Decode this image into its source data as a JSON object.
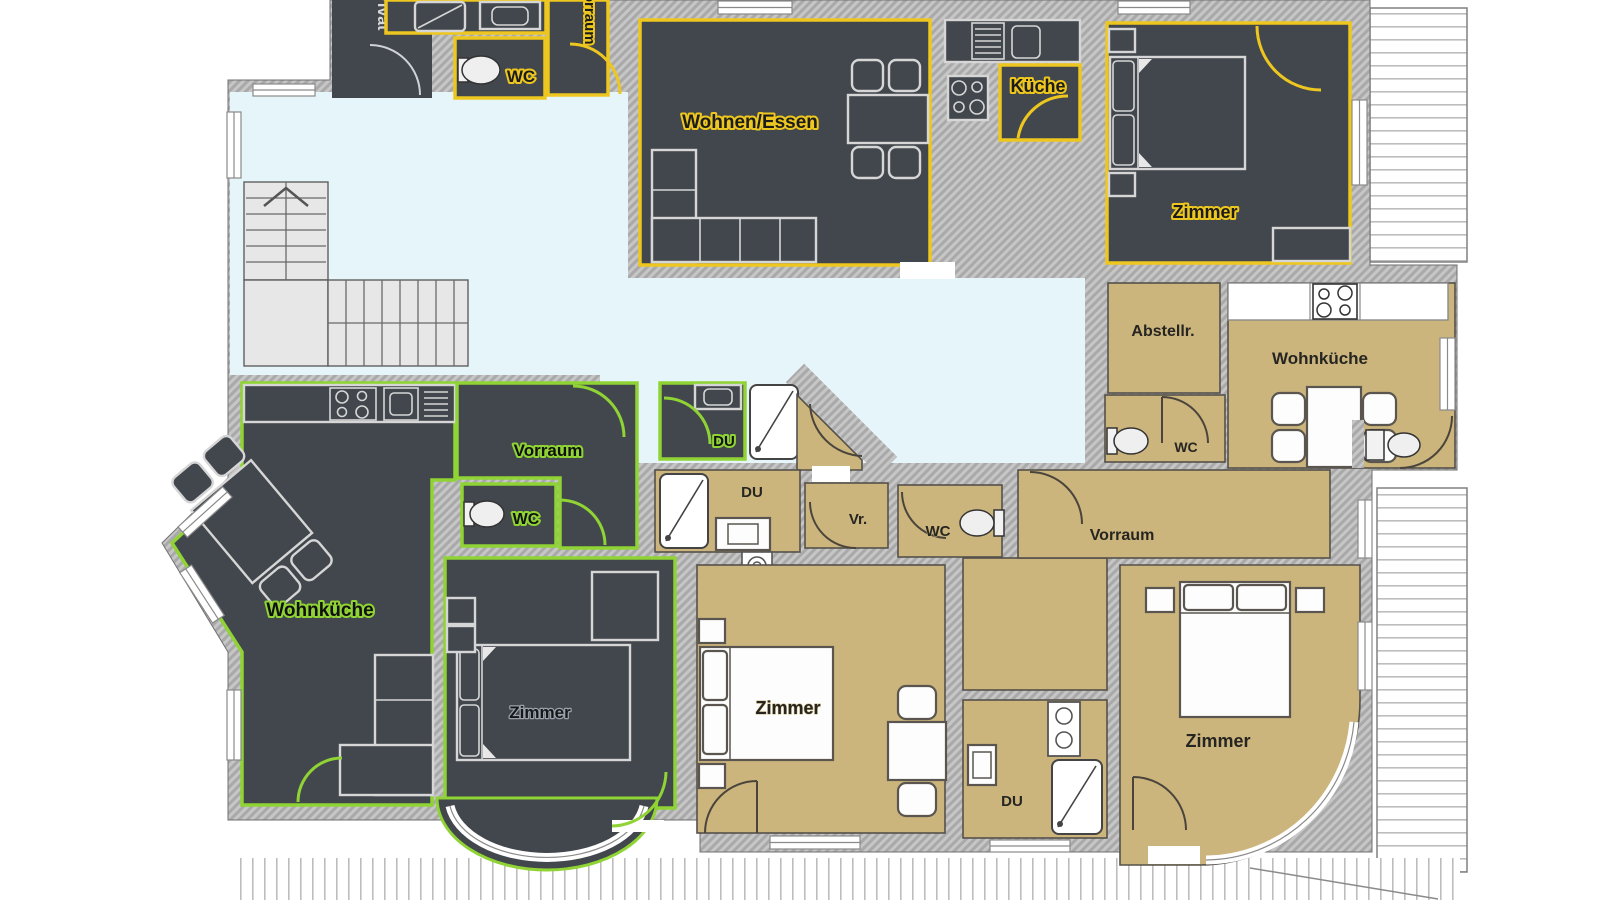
{
  "plan_title": "Apartment floor plan",
  "colors": {
    "wall_gray": "#a9a9a9",
    "dark_floor": "#42474d",
    "tan_floor": "#cbb57c",
    "hall_blue": "#e6f5f9",
    "yellow_outline": "#edc71f",
    "green_outline": "#8fd334",
    "stairs_gray": "#e7e7e7"
  },
  "apartments": {
    "top_yellow": {
      "outline_color": "#edc71f",
      "floor_color": "#42474d",
      "rooms": {
        "privat": "Privat",
        "vorraum": "Vorraum",
        "wc": "WC",
        "wohnen_essen": "Wohnen/Essen",
        "kueche": "Küche",
        "zimmer": "Zimmer"
      }
    },
    "left_green": {
      "outline_color": "#8fd334",
      "floor_color": "#42474d",
      "rooms": {
        "wohnkueche": "Wohnküche",
        "vorraum": "Vorraum",
        "wc": "WC",
        "du": "DU",
        "zimmer": "Zimmer"
      }
    },
    "middle_small": {
      "floor_color": "#cbb57c",
      "rooms": {
        "du": "DU",
        "vr": "Vr.",
        "wc": "WC",
        "zimmer": "Zimmer"
      }
    },
    "right_tan": {
      "floor_color": "#cbb57c",
      "rooms": {
        "abstellraum": "Abstellr.",
        "wc": "WC",
        "wohnkueche": "Wohnküche",
        "vorraum": "Vorraum",
        "zimmer": "Zimmer",
        "du": "DU"
      }
    }
  }
}
